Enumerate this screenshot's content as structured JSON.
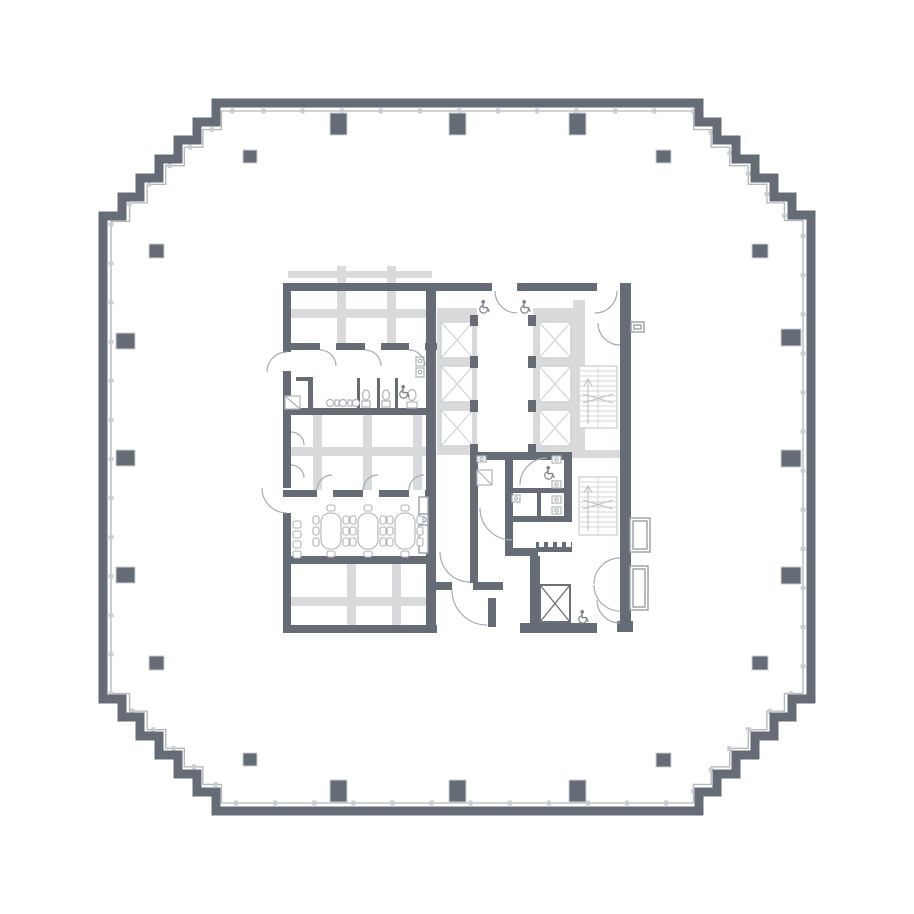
{
  "plan": {
    "kind": "high-rise-office-floor-plan",
    "perimeter_shape": "stepped-octagon",
    "perimeter_columns": 20,
    "passenger_elevators": 6,
    "service_elevators": 1,
    "stairwells": 2,
    "conference_tables": 3,
    "conference_chairs_per_table": 8,
    "wall_side_chairs": 4,
    "accessible_icons": 5,
    "restrooms": 2
  },
  "colors": {
    "background": "#ffffff",
    "wall": "#656c76",
    "wall_light": "#d9dadc",
    "shaft_line": "#cfd2d6",
    "line": "#a6abb2",
    "fixture": "#aeb3b9",
    "stair": "#d2d5d8",
    "stair_mark": "#bdc1c6",
    "column_border": "#cdcfd2",
    "icon": "#7a818b",
    "mullion": "#c9ccd0",
    "inner_line": "#b3b7bd",
    "casework": "#9aa0a8"
  }
}
